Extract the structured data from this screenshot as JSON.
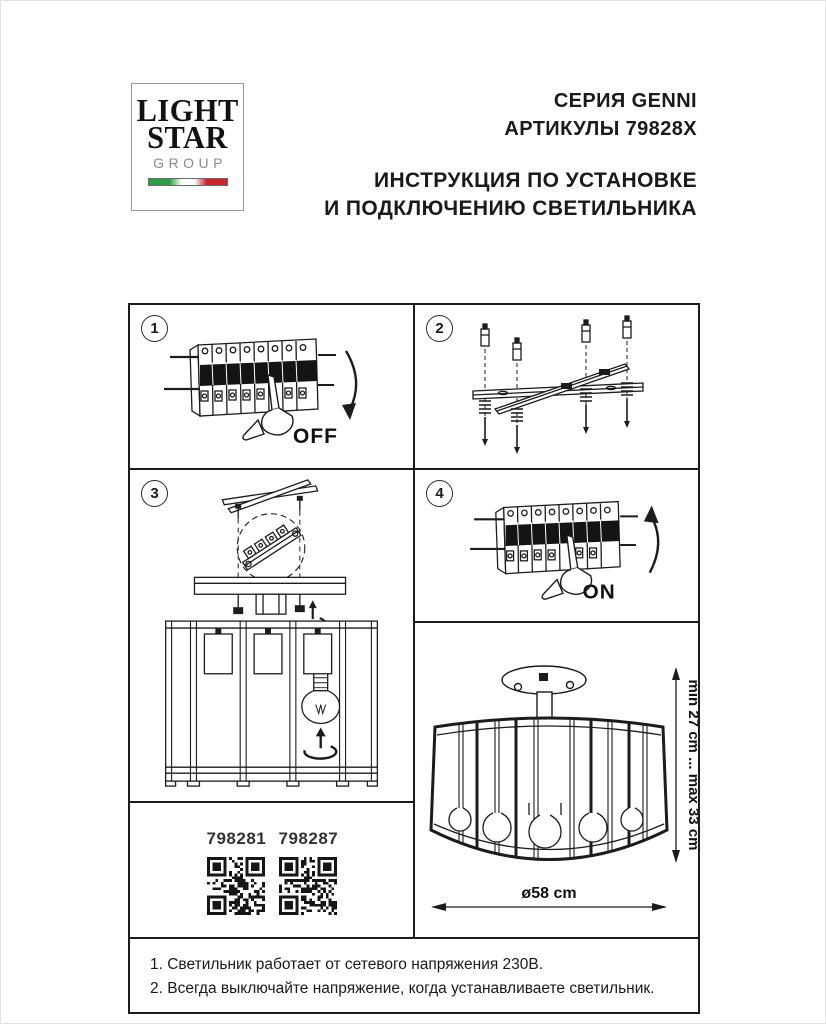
{
  "logo": {
    "line1": "LIGHT",
    "line2": "STAR",
    "line3": "GROUP"
  },
  "header": {
    "series": "СЕРИЯ GENNI",
    "articles": "АРТИКУЛЫ 79828X",
    "title_line1": "ИНСТРУКЦИЯ ПО УСТАНОВКЕ",
    "title_line2": "И ПОДКЛЮЧЕНИЮ СВЕТИЛЬНИКА"
  },
  "steps": {
    "step1": {
      "number": "1",
      "label": "OFF"
    },
    "step2": {
      "number": "2"
    },
    "step3": {
      "number": "3"
    },
    "step4": {
      "number": "4",
      "label": "ON"
    }
  },
  "qr": {
    "items": [
      {
        "code": "798281"
      },
      {
        "code": "798287"
      }
    ]
  },
  "dimensions": {
    "height": "min 27 cm ... max 33 cm",
    "diameter": "ø58 cm"
  },
  "notes": {
    "line1": "1. Светильник работает от сетевого напряжения 230В.",
    "line2": "2. Всегда выключайте напряжение, когда устанавливаете светильник."
  },
  "colors": {
    "line": "#1c1c1c",
    "flag_green": "#2e9b45",
    "flag_red": "#c9252c",
    "logo_gray": "#8c8c8c"
  }
}
